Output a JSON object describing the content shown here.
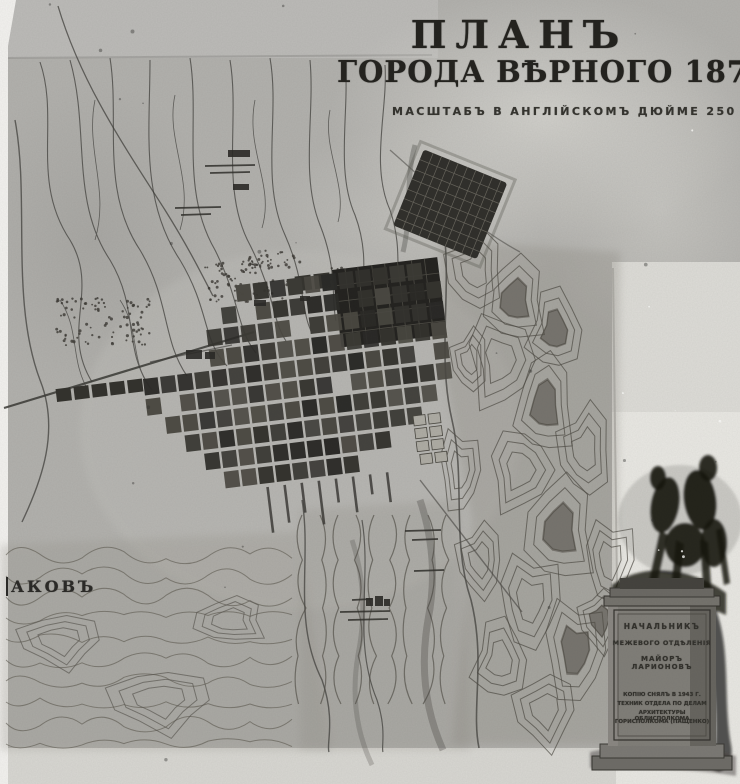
{
  "photo": {
    "title_line1": "ПЛАНЪ",
    "title_line2": "ГОРОДА ВѢРНОГО 1879 ГОДА",
    "scale_note": "МАСШТАБЪ В АНГЛІЙСКОМЪ ДЮЙМЕ 250 САЖ.",
    "edge_label": "АКОВЪ",
    "cartouche": {
      "line1": "НАЧАЛЬНИКЪ",
      "line2": "МЕЖЕВОГО ОТДѢЛЕНІЯ",
      "line3": "МАЙОРЪ ЛАРИОНОВЪ",
      "note_line1": "КОПІЮ СНЯЛЪ В 1943 Г.",
      "note_line2": "ТЕХНИК ОТДЕЛА ПО ДЕЛАМ",
      "note_line3": "АРХИТЕКТУРЫ ОБЛИСПОЛКОМА",
      "note_line4": "ГОРИСПОЛКОМА (ПАЩЕНКО)"
    },
    "colors": {
      "paper": "#b4b3af",
      "margin": "#e9e8e3",
      "ink": "#23221e",
      "block_dark": "#2b2a27"
    }
  }
}
